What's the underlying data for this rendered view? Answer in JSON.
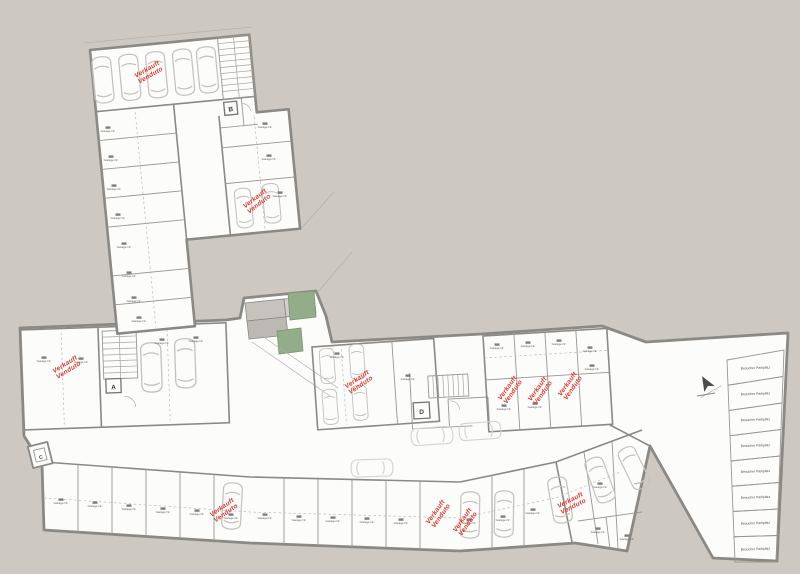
{
  "plan": {
    "labels": {
      "sold_line1": "Verkauft",
      "sold_line2": "Venduto",
      "visitor_stall": "Besucher Parkplatz",
      "garage_unit": "Garage Nr."
    },
    "elevators": {
      "a": "A",
      "b": "B",
      "c": "C",
      "d": "D"
    },
    "sold_units": [
      {
        "x": 148,
        "y": 71,
        "r": -30
      },
      {
        "x": 256,
        "y": 200,
        "r": -38
      },
      {
        "x": 66,
        "y": 366,
        "r": -32
      },
      {
        "x": 358,
        "y": 381,
        "r": -34
      },
      {
        "x": 509,
        "y": 389,
        "r": -55
      },
      {
        "x": 539,
        "y": 390,
        "r": -55
      },
      {
        "x": 569,
        "y": 385,
        "r": -55
      },
      {
        "x": 223,
        "y": 509,
        "r": -35
      },
      {
        "x": 437,
        "y": 513,
        "r": -55
      },
      {
        "x": 464,
        "y": 521,
        "r": -55
      },
      {
        "x": 571,
        "y": 502,
        "r": -27
      }
    ],
    "visitor_parking": {
      "count": 8
    },
    "colors": {
      "background": "#cdc8c1",
      "floor": "#fcfcfa",
      "wall": "#8b8985",
      "green": "#93ac8a",
      "red": "#d93a32"
    }
  }
}
